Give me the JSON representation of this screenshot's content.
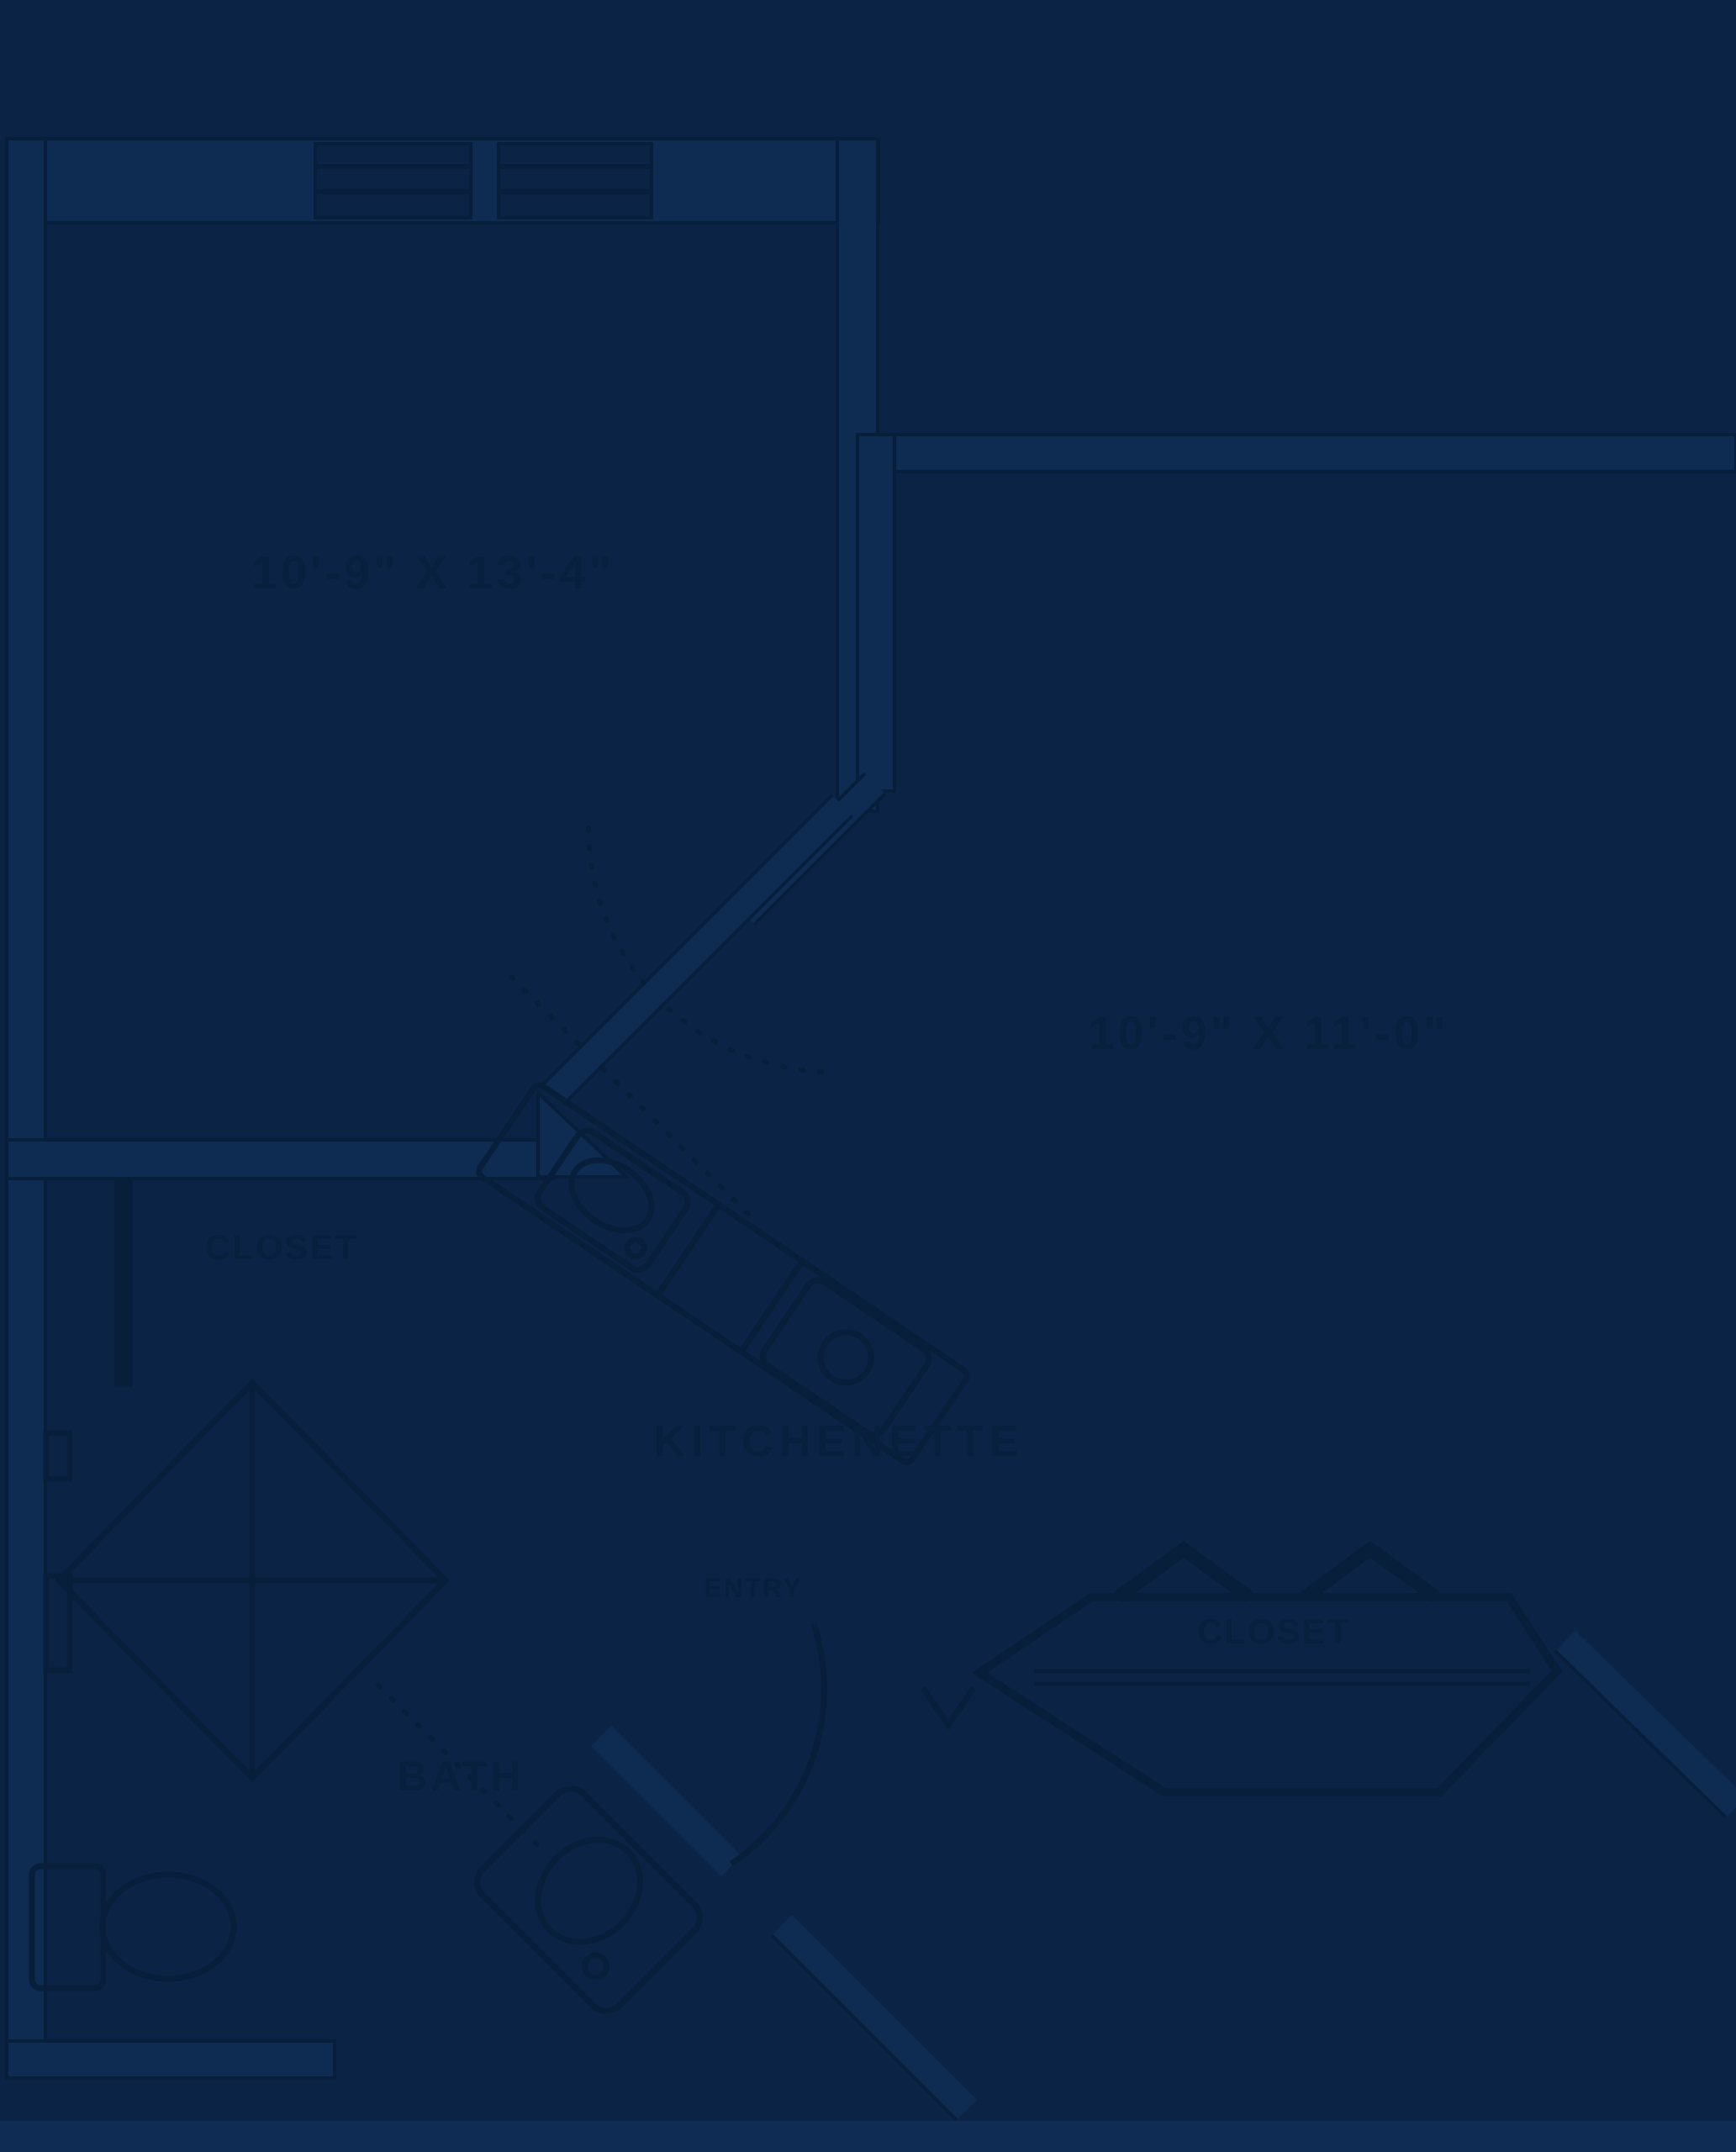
{
  "colors": {
    "background": "#0B2445",
    "line": "#081F3B",
    "wall_fill": "#0E2B52",
    "text": "#07203D",
    "footer_strip": "#0F2C55"
  },
  "floor_plan": {
    "type": "apartment-floor-plan",
    "rooms": [
      {
        "id": "room-1",
        "dimensions": "10'-9\" X 13'-4\""
      },
      {
        "id": "room-2",
        "dimensions": "10'-9\" X 11'-0\""
      }
    ],
    "labels": {
      "kitchenette": "KITCHENETTE",
      "closet_left": "CLOSET",
      "closet_right": "CLOSET",
      "bath": "BATH",
      "entry": "ENTRY"
    }
  }
}
